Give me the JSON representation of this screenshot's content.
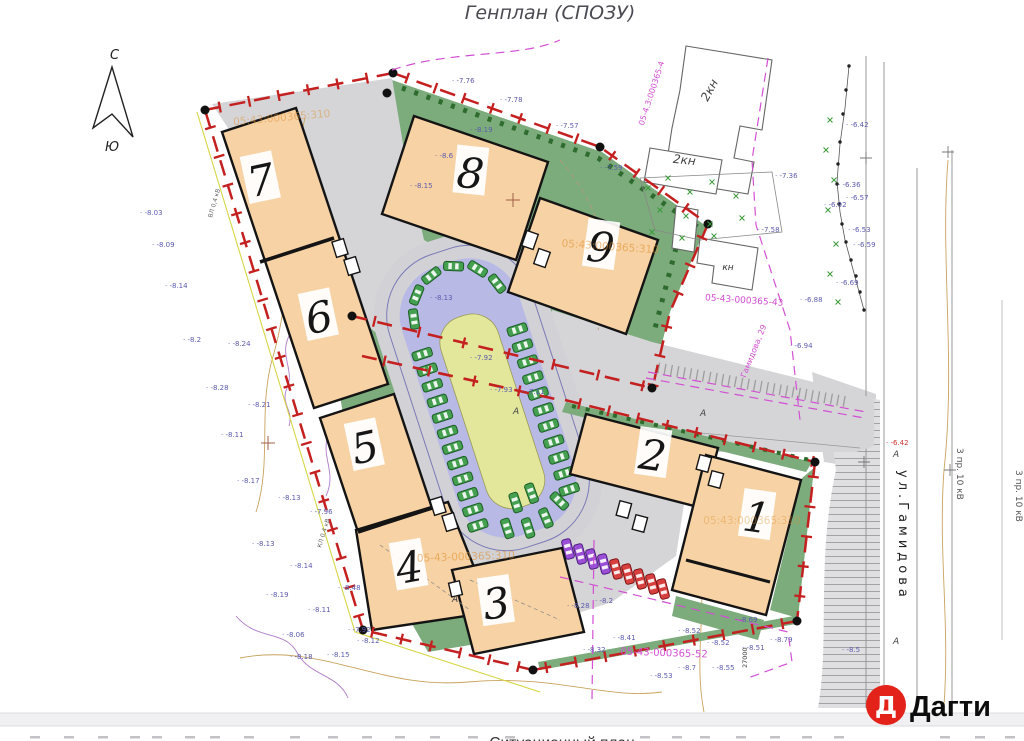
{
  "page": {
    "title": "Генплан (СПОЗУ)",
    "caption": "Ситуационный план"
  },
  "brand": {
    "logo_letter": "Д",
    "name": "Дагти",
    "logo_color": "#e32219"
  },
  "compass": {
    "north": "С",
    "south": "Ю"
  },
  "plan": {
    "buildings": [
      {
        "label": "1"
      },
      {
        "label": "2"
      },
      {
        "label": "3"
      },
      {
        "label": "4"
      },
      {
        "label": "5"
      },
      {
        "label": "6"
      },
      {
        "label": "7"
      },
      {
        "label": "8"
      },
      {
        "label": "9"
      }
    ],
    "neighbors": {
      "kn2_a": "2кн",
      "kn2_b": "2кн",
      "kn": "кн"
    },
    "street": {
      "name": "ул.Гамидова",
      "road_letter": "А",
      "power_line_a": "3 пр. 10 кВ",
      "power_line_b": "3 пр. 10 кВ"
    },
    "cadastral": {
      "site_over_9": "05:43:000365:310",
      "site_over_parking": "05-43-000365:310",
      "site_over_1": "05:43:000365:310",
      "site_top_left": "05:43:000365:310",
      "parcel_right": "05-43-000365-43",
      "parcel_bottom": "05-43-000365-52",
      "parcel_top": "05-4.3:000365-4",
      "address_line": "Гамидова, 29",
      "axis_mark": "27000"
    },
    "utilities": {
      "cable_a": "КЛ 0,4 кВ",
      "cable_b": "ВЛ 0,4 кВ"
    },
    "colors": {
      "boundary": "#c42020",
      "building": "#f7d2a4",
      "green": "#7cab7c",
      "parking_band": "#b9b9e6",
      "island": "#e3e79b",
      "road": "#d5d5d8",
      "magenta": "#d24fd2",
      "spot_label": "#5c5cad",
      "car_green": "#45a052",
      "car_purple": "#9b4fd6",
      "car_red": "#d84040"
    },
    "spot_elevations": [
      {
        "x": 140,
        "y": 215,
        "t": "-8.03"
      },
      {
        "x": 152,
        "y": 247,
        "t": "-8.09"
      },
      {
        "x": 165,
        "y": 288,
        "t": "-8.14"
      },
      {
        "x": 183,
        "y": 342,
        "t": "-8.2"
      },
      {
        "x": 228,
        "y": 346,
        "t": "-8.24"
      },
      {
        "x": 206,
        "y": 390,
        "t": "-8.28"
      },
      {
        "x": 248,
        "y": 407,
        "t": "-8.21"
      },
      {
        "x": 221,
        "y": 437,
        "t": "-8.11"
      },
      {
        "x": 237,
        "y": 483,
        "t": "-8.17"
      },
      {
        "x": 278,
        "y": 500,
        "t": "-8.13"
      },
      {
        "x": 310,
        "y": 514,
        "t": "-7.96"
      },
      {
        "x": 252,
        "y": 546,
        "t": "-8.13"
      },
      {
        "x": 290,
        "y": 568,
        "t": "-8.14"
      },
      {
        "x": 338,
        "y": 590,
        "t": "-8.48"
      },
      {
        "x": 266,
        "y": 597,
        "t": "-8.19"
      },
      {
        "x": 308,
        "y": 612,
        "t": "-8.11"
      },
      {
        "x": 282,
        "y": 637,
        "t": "-8.06"
      },
      {
        "x": 348,
        "y": 632,
        "t": "-7.92"
      },
      {
        "x": 357,
        "y": 643,
        "t": "-8.12"
      },
      {
        "x": 290,
        "y": 659,
        "t": "-8.18"
      },
      {
        "x": 327,
        "y": 657,
        "t": "-8.15"
      },
      {
        "x": 452,
        "y": 83,
        "t": "-7.76"
      },
      {
        "x": 500,
        "y": 102,
        "t": "-7.78"
      },
      {
        "x": 556,
        "y": 128,
        "t": "-7.57"
      },
      {
        "x": 600,
        "y": 170,
        "t": "-7.59"
      },
      {
        "x": 470,
        "y": 132,
        "t": "-8.19"
      },
      {
        "x": 435,
        "y": 158,
        "t": "-8.6"
      },
      {
        "x": 410,
        "y": 188,
        "t": "-8.15"
      },
      {
        "x": 470,
        "y": 360,
        "t": "-7.92"
      },
      {
        "x": 490,
        "y": 392,
        "t": "-7.93"
      },
      {
        "x": 522,
        "y": 394,
        "t": "-7.11"
      },
      {
        "x": 430,
        "y": 300,
        "t": "-8.13"
      },
      {
        "x": 567,
        "y": 608,
        "t": "-8.28"
      },
      {
        "x": 595,
        "y": 603,
        "t": "-8.2"
      },
      {
        "x": 613,
        "y": 640,
        "t": "-8.41"
      },
      {
        "x": 583,
        "y": 652,
        "t": "-8.32"
      },
      {
        "x": 678,
        "y": 633,
        "t": "-8.52"
      },
      {
        "x": 707,
        "y": 645,
        "t": "-8.52"
      },
      {
        "x": 742,
        "y": 650,
        "t": "-8.51"
      },
      {
        "x": 770,
        "y": 642,
        "t": "-8.79"
      },
      {
        "x": 735,
        "y": 622,
        "t": "-8.69"
      },
      {
        "x": 678,
        "y": 670,
        "t": "-8.7"
      },
      {
        "x": 712,
        "y": 670,
        "t": "-8.55"
      },
      {
        "x": 650,
        "y": 678,
        "t": "-8.53"
      },
      {
        "x": 842,
        "y": 652,
        "t": "-8.5"
      },
      {
        "x": 775,
        "y": 178,
        "t": "-7.36"
      },
      {
        "x": 757,
        "y": 232,
        "t": "-7.58"
      },
      {
        "x": 846,
        "y": 127,
        "t": "-6.42"
      },
      {
        "x": 838,
        "y": 187,
        "t": "-6.36"
      },
      {
        "x": 846,
        "y": 200,
        "t": "-6.57"
      },
      {
        "x": 848,
        "y": 232,
        "t": "-6.53"
      },
      {
        "x": 853,
        "y": 247,
        "t": "-6.59"
      },
      {
        "x": 836,
        "y": 285,
        "t": "-6.69"
      },
      {
        "x": 824,
        "y": 207,
        "t": "-6.92"
      },
      {
        "x": 800,
        "y": 302,
        "t": "-6.88"
      },
      {
        "x": 790,
        "y": 348,
        "t": "-6.94"
      },
      {
        "x": 886,
        "y": 445,
        "t": "-6.42",
        "c": "r"
      }
    ]
  }
}
